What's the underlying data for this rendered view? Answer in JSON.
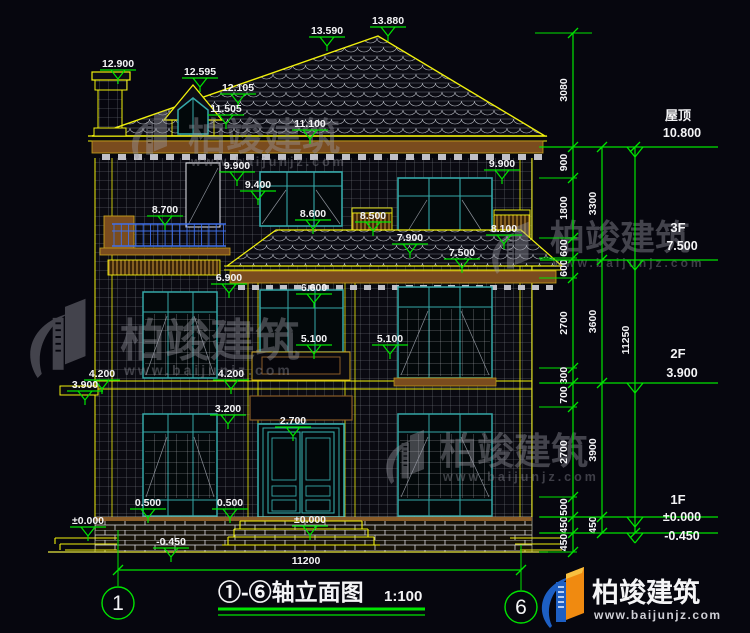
{
  "drawing": {
    "title": "①-⑥轴立面图",
    "scale": "1:100",
    "axis_start": "1",
    "axis_end": "6",
    "overall_width_dim": "11200"
  },
  "levels": [
    {
      "text": "12.900",
      "x": 118,
      "y": 70
    },
    {
      "text": "13.590",
      "x": 327,
      "y": 37
    },
    {
      "text": "13.880",
      "x": 388,
      "y": 27
    },
    {
      "text": "12.595",
      "x": 200,
      "y": 78
    },
    {
      "text": "12.105",
      "x": 238,
      "y": 94
    },
    {
      "text": "11.505",
      "x": 226,
      "y": 115
    },
    {
      "text": "11.100",
      "x": 310,
      "y": 130
    },
    {
      "text": "9.900",
      "x": 237,
      "y": 172
    },
    {
      "text": "9.900",
      "x": 502,
      "y": 170
    },
    {
      "text": "9.400",
      "x": 258,
      "y": 191
    },
    {
      "text": "8.700",
      "x": 165,
      "y": 216
    },
    {
      "text": "8.600",
      "x": 313,
      "y": 220
    },
    {
      "text": "8.500",
      "x": 373,
      "y": 222
    },
    {
      "text": "8.100",
      "x": 504,
      "y": 235
    },
    {
      "text": "7.900",
      "x": 410,
      "y": 244
    },
    {
      "text": "7.500",
      "x": 462,
      "y": 259
    },
    {
      "text": "6.900",
      "x": 229,
      "y": 284
    },
    {
      "text": "6.600",
      "x": 314,
      "y": 294
    },
    {
      "text": "5.100",
      "x": 314,
      "y": 345
    },
    {
      "text": "5.100",
      "x": 390,
      "y": 345
    },
    {
      "text": "4.200",
      "x": 102,
      "y": 380
    },
    {
      "text": "4.200",
      "x": 231,
      "y": 380
    },
    {
      "text": "3.900",
      "x": 85,
      "y": 391
    },
    {
      "text": "3.200",
      "x": 228,
      "y": 415
    },
    {
      "text": "2.700",
      "x": 293,
      "y": 427
    },
    {
      "text": "0.500",
      "x": 148,
      "y": 509
    },
    {
      "text": "0.500",
      "x": 230,
      "y": 509
    },
    {
      "text": "±0.000",
      "x": 88,
      "y": 527
    },
    {
      "text": "±0.000",
      "x": 310,
      "y": 526
    },
    {
      "text": "-0.450",
      "x": 171,
      "y": 548
    }
  ],
  "right_dims": {
    "columns": [
      {
        "x": 573,
        "stubs": true,
        "boundaries": [
          33,
          147,
          178,
          238,
          258,
          278,
          368,
          383,
          407,
          497,
          517,
          533,
          552
        ],
        "labels": [
          "3080",
          "900",
          "1800",
          "600",
          "600",
          "2700",
          "300",
          "700",
          "2700",
          "500",
          "450",
          "450"
        ]
      },
      {
        "x": 602,
        "stubs": false,
        "boundaries": [
          147,
          260,
          383,
          517,
          533
        ],
        "labels": [
          "3300",
          "3600",
          "3900",
          "450"
        ]
      },
      {
        "x": 635,
        "stubs": false,
        "boundaries": [
          147,
          533
        ],
        "labels": [
          "11250"
        ]
      }
    ]
  },
  "floor_markers": [
    {
      "name": "屋顶",
      "elev": "10.800",
      "y": 147,
      "ndy": -27,
      "edy": -10
    },
    {
      "name": "3F",
      "elev": "7.500",
      "y": 260,
      "ndy": -28,
      "edy": -10
    },
    {
      "name": "2F",
      "elev": "3.900",
      "y": 383,
      "ndy": -25,
      "edy": -6
    },
    {
      "name": "1F",
      "elev": "±0.000",
      "y": 517,
      "ndy": -13,
      "edy": 4
    },
    {
      "name": "",
      "elev": "-0.450",
      "y": 533,
      "ndy": 0,
      "edy": 7
    }
  ],
  "watermark": {
    "brand": "柏竣建筑",
    "site": "www.baijunjz.com"
  },
  "logo": {
    "brand": "柏竣建筑",
    "site": "www.baijunjz.com"
  },
  "colors": {
    "background": "#06060e",
    "dim_green": "#00e400",
    "outline_yellow": "#f0f00c",
    "window_teal": "#35a8a8",
    "railing_blue": "#3f6fe8",
    "trim_brown": "#7a4c1e",
    "text_white": "#f4f4f6"
  }
}
